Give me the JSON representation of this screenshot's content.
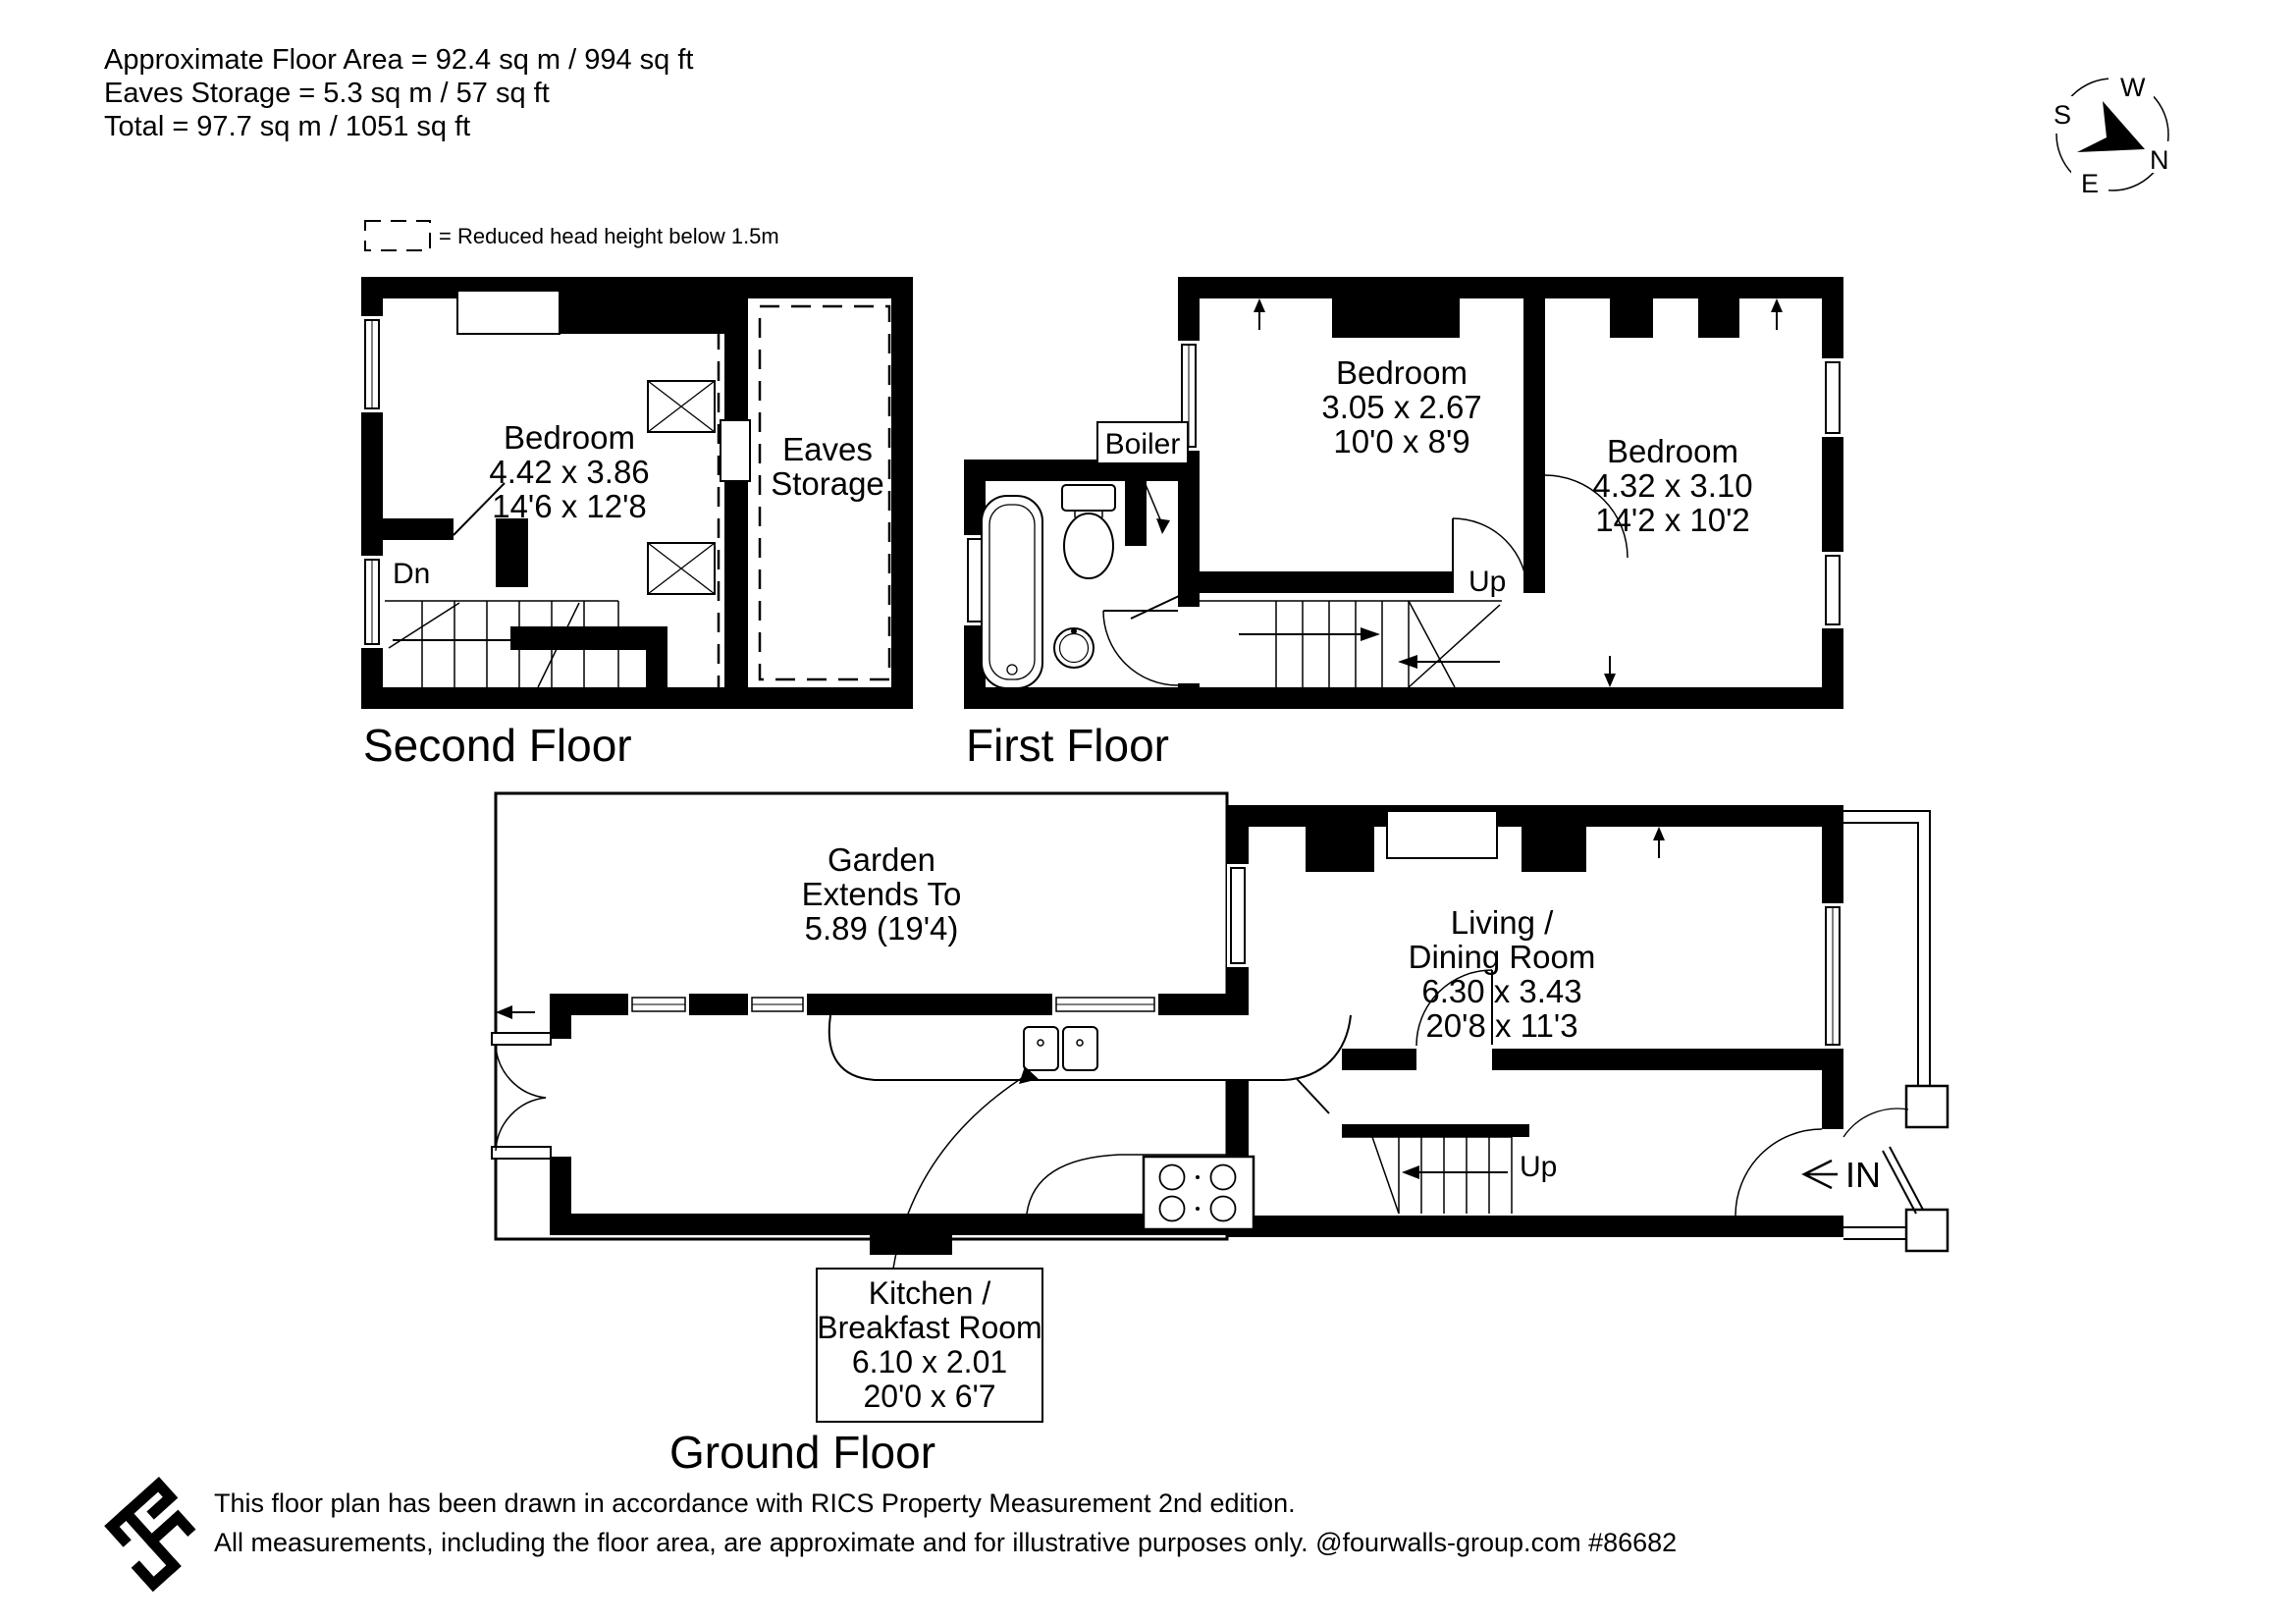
{
  "header": {
    "line1": "Approximate Floor Area = 92.4 sq m / 994 sq ft",
    "line2": "Eaves Storage = 5.3 sq m / 57 sq ft",
    "line3": "Total = 97.7 sq m / 1051 sq ft"
  },
  "legend": {
    "text": "= Reduced head height below 1.5m"
  },
  "compass": {
    "n": "N",
    "s": "S",
    "e": "E",
    "w": "W"
  },
  "floors": {
    "second": {
      "title": "Second Floor",
      "bedroom": {
        "name": "Bedroom",
        "metric": "4.42 x 3.86",
        "imperial": "14'6 x 12'8"
      },
      "eaves": {
        "line1": "Eaves",
        "line2": "Storage"
      },
      "stairs_label": "Dn"
    },
    "first": {
      "title": "First Floor",
      "boiler_label": "Boiler",
      "bedroom1": {
        "name": "Bedroom",
        "metric": "3.05 x 2.67",
        "imperial": "10'0 x 8'9"
      },
      "bedroom2": {
        "name": "Bedroom",
        "metric": "4.32 x 3.10",
        "imperial": "14'2 x 10'2"
      },
      "stairs_label": "Up"
    },
    "ground": {
      "title": "Ground Floor",
      "garden": {
        "line1": "Garden",
        "line2": "Extends To",
        "line3": "5.89 (19'4)"
      },
      "living": {
        "line1": "Living /",
        "line2": "Dining Room",
        "metric": "6.30 x 3.43",
        "imperial": "20'8 x 11'3"
      },
      "kitchen": {
        "line1": "Kitchen /",
        "line2": "Breakfast Room",
        "metric": "6.10 x 2.01",
        "imperial": "20'0 x 6'7"
      },
      "stairs_label": "Up",
      "entrance_label": "IN"
    }
  },
  "footer": {
    "line1": "This floor plan has been drawn in accordance with RICS Property Measurement 2nd edition.",
    "line2": "All measurements, including the floor area, are approximate and for illustrative purposes only. @fourwalls-group.com #86682"
  },
  "colors": {
    "ink": "#000000",
    "background": "#ffffff"
  }
}
